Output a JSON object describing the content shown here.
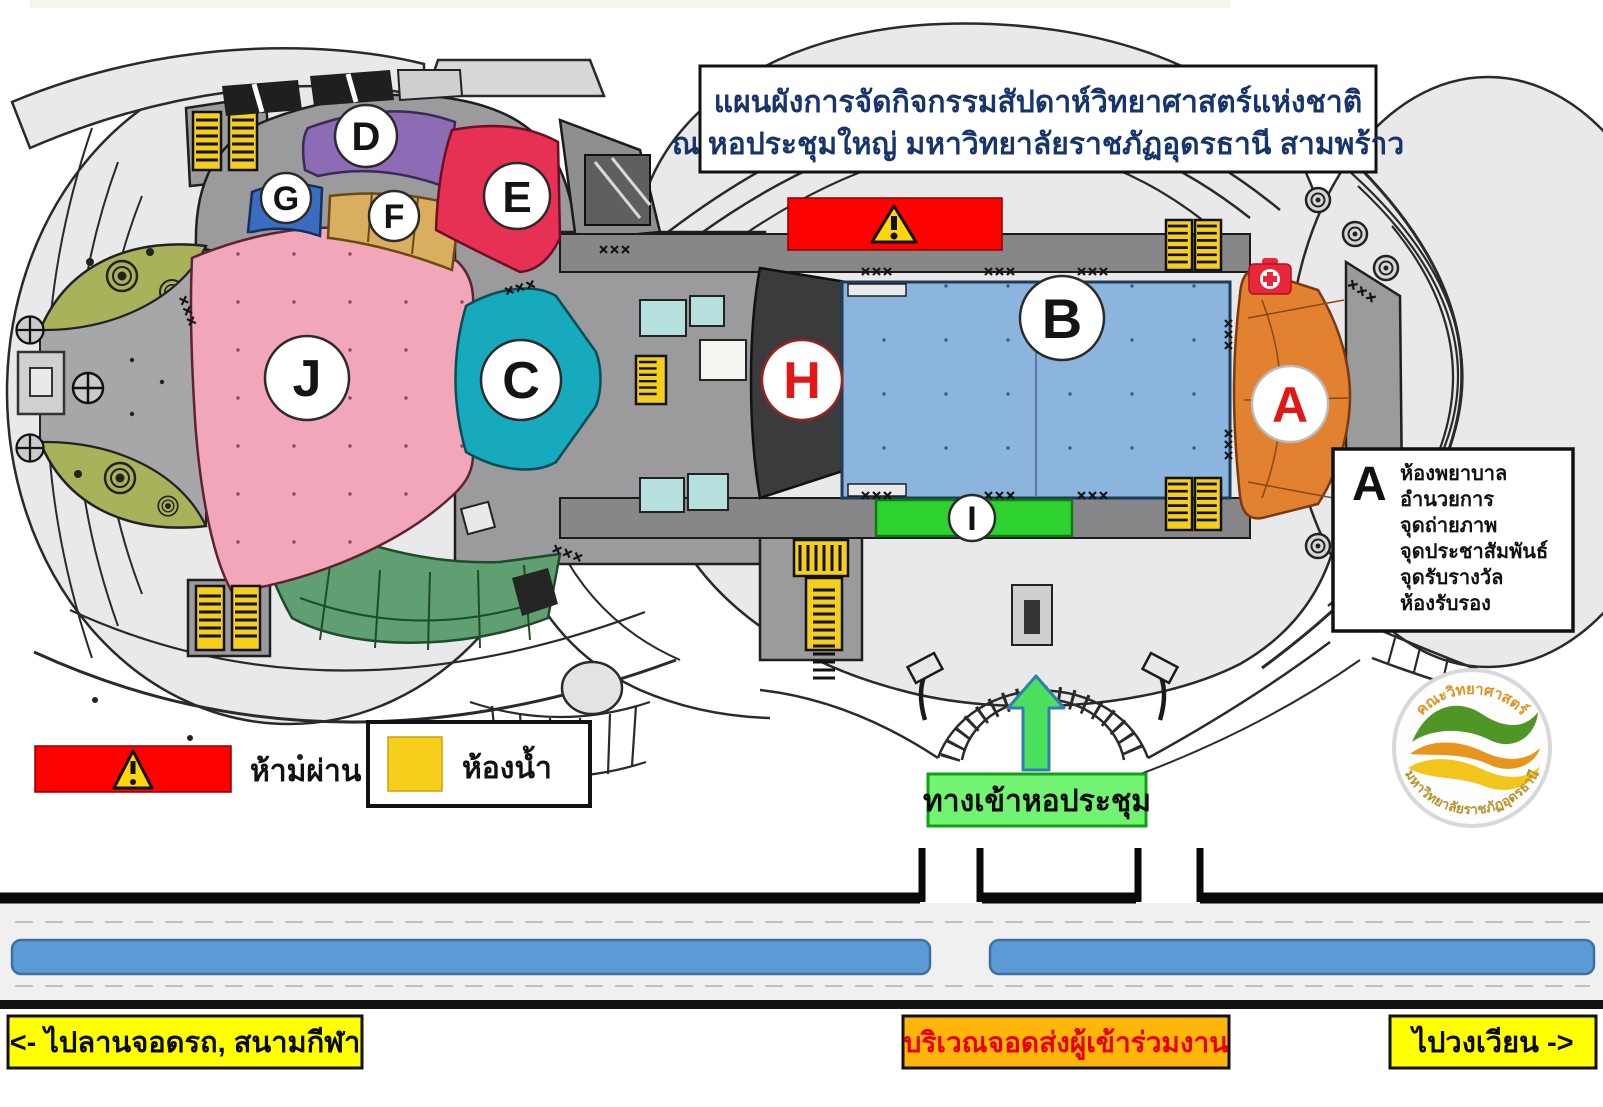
{
  "title": {
    "line1": "แผนผังการจัดกิจกรรมสัปดาห์วิทยาศาสตร์แห่งชาติ",
    "line2": "ณ หอประชุมใหญ่ มหาวิทยาลัยราชภัฏอุดรธานี สามพร้าว"
  },
  "zones": {
    "a": {
      "letter": "A"
    },
    "b": {
      "letter": "B"
    },
    "c": {
      "letter": "C"
    },
    "d": {
      "letter": "D"
    },
    "e": {
      "letter": "E"
    },
    "f": {
      "letter": "F"
    },
    "g": {
      "letter": "G"
    },
    "h": {
      "letter": "H"
    },
    "i": {
      "letter": "I"
    },
    "j": {
      "letter": "J"
    }
  },
  "zone_a_legend": {
    "letter": "A",
    "items": [
      "ห้องพยาบาล",
      "อำนวยการ",
      "จุดถ่ายภาพ",
      "จุดประชาสัมพันธ์",
      "จุดรับรางวัล",
      "ห้องรับรอง"
    ]
  },
  "legend": {
    "no_pass": "ห้ามผ่าน",
    "restroom": "ห้องน้ำ"
  },
  "entrance": {
    "label": "ทางเข้าหอประชุม"
  },
  "road_labels": {
    "left": "<- ไปลานจอดรถ, สนามกีฬา",
    "center": "บริเวณจอดส่งผู้เข้าร่วมงาน",
    "right": "ไปวงเวียน ->"
  },
  "logo": {
    "top": "คณะวิทยาศาสตร์",
    "bottom": "มหาวิทยาลัยราชภัฏอุดรธานี"
  },
  "colors": {
    "zone_a": "#e2812f",
    "zone_b": "#8cb5de",
    "zone_c": "#17a9bc",
    "zone_d": "#8d6cb5",
    "zone_e": "#e63054",
    "zone_f": "#d9ae5f",
    "zone_g": "#3b6cc0",
    "zone_h": "#3b3b3d",
    "zone_i": "#2fd32f",
    "zone_j": "#f2a6ba",
    "garden": "#a9b25a",
    "lawn": "#5f9f72",
    "stairs": "#f5cf1b",
    "aqua_room": "#b5e0dd",
    "no_pass": "#fe0101",
    "warning": "#ffd60a",
    "first_aid": "#e8273a",
    "entrance_box": "#72f472",
    "arrow": "#4ce05e",
    "lane": "#5b9bd5",
    "label_yellow": "#ffff00",
    "label_orange": "#ffb60a",
    "label_red_text": "#e80000",
    "title_text": "#17356b",
    "red_letter": "#e01818"
  }
}
